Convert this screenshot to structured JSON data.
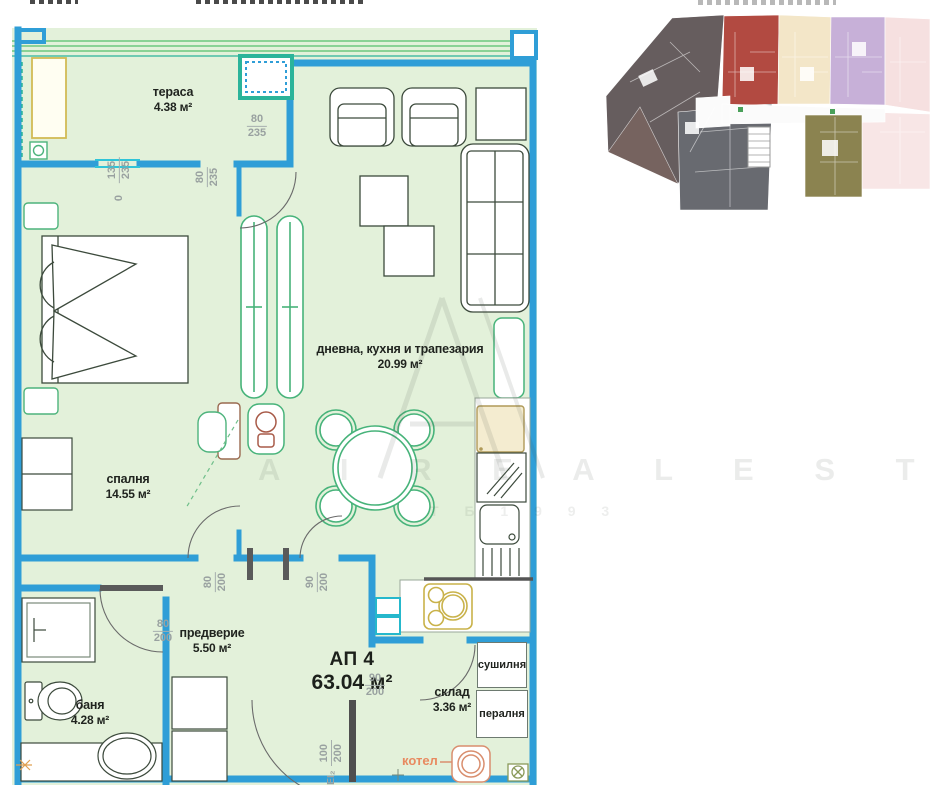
{
  "plan": {
    "rooms": {
      "terrace": {
        "label": "тераса",
        "area": "4.38 м²"
      },
      "bedroom": {
        "label": "спалня",
        "area": "14.55 м²"
      },
      "living": {
        "label": "дневна, кухня и трапезария",
        "area": "20.99 м²"
      },
      "hall": {
        "label": "предверие",
        "area": "5.50 м²"
      },
      "bath": {
        "label": "баня",
        "area": "4.28 м²"
      },
      "storage": {
        "label": "склад",
        "area": "3.36 м²"
      }
    },
    "apartment": {
      "name": "АП 4",
      "area": "63.04 м²"
    },
    "fixtures": {
      "dryer": "сушилня",
      "washer": "пералня",
      "boiler": "котел"
    },
    "dims": {
      "terrace_door": {
        "w": "80",
        "h": "235"
      },
      "terrace_window": {
        "w": "135",
        "h": "235",
        "zero": "0"
      },
      "terrace_bed": {
        "w": "80",
        "h": "235"
      },
      "bedroom_door": {
        "w": "80",
        "h": "200"
      },
      "living_door": {
        "w": "90",
        "h": "200"
      },
      "bath_door": {
        "w": "80",
        "h": "200"
      },
      "storage_door": {
        "w": "90",
        "h": "200"
      },
      "entrance": {
        "spec": "ЕІ₂",
        "w": "100",
        "h": "200"
      }
    }
  },
  "watermark": {
    "letters": "A I R E A L E S T A T E",
    "sub": "Т Б 1 9 9 3"
  },
  "colors": {
    "wall_blue": "#2f9ed7",
    "cyan": "#2fc4d8",
    "teal": "#2bb49a",
    "plan_green": "#e3f1da",
    "furniture_green": "#4db37c",
    "dim_gray": "#99a1a0",
    "label_dark": "#20241f",
    "orange": "#e88a60",
    "yellow": "#d2bb55",
    "key_dark": "#665d5e",
    "key_gray": "#686a70",
    "key_red": "#b24a41",
    "key_cream": "#f3e6c8",
    "key_purple": "#c7b0d8",
    "key_pink": "#f6e0e0",
    "key_olive": "#8b8350"
  }
}
